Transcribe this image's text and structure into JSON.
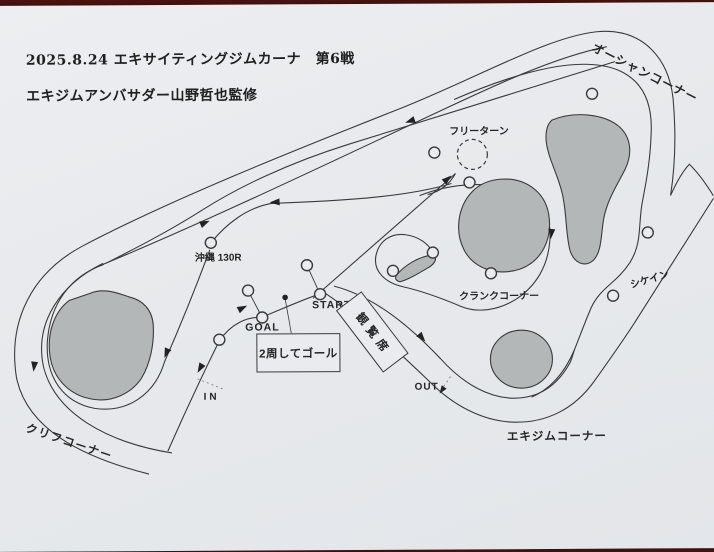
{
  "document": {
    "title_line1": "2025.8.24 エキサイティングジムカーナ　第6戦",
    "title_line2": "エキジムアンバサダー山野哲也監修"
  },
  "course": {
    "corners": {
      "ocean": "オーシャンコーナー",
      "cliff": "クリフコーナー",
      "crank": "クランクコーナー",
      "exigym": "エキジムコーナー",
      "chicane": "シケイン",
      "free_turn": "フリーターン",
      "okinawa_130r": "沖縄 130R"
    },
    "markers": {
      "start": "START",
      "goal": "GOAL",
      "in": "IN",
      "out": "OUT"
    },
    "facilities": {
      "grandstand": "観覧席"
    },
    "note": "2周してゴール"
  },
  "colors": {
    "photo_background": "#4a1410",
    "paper": "#e8eaed",
    "ink": "#3a3a3a",
    "island_fill": "#b3b7b8"
  }
}
